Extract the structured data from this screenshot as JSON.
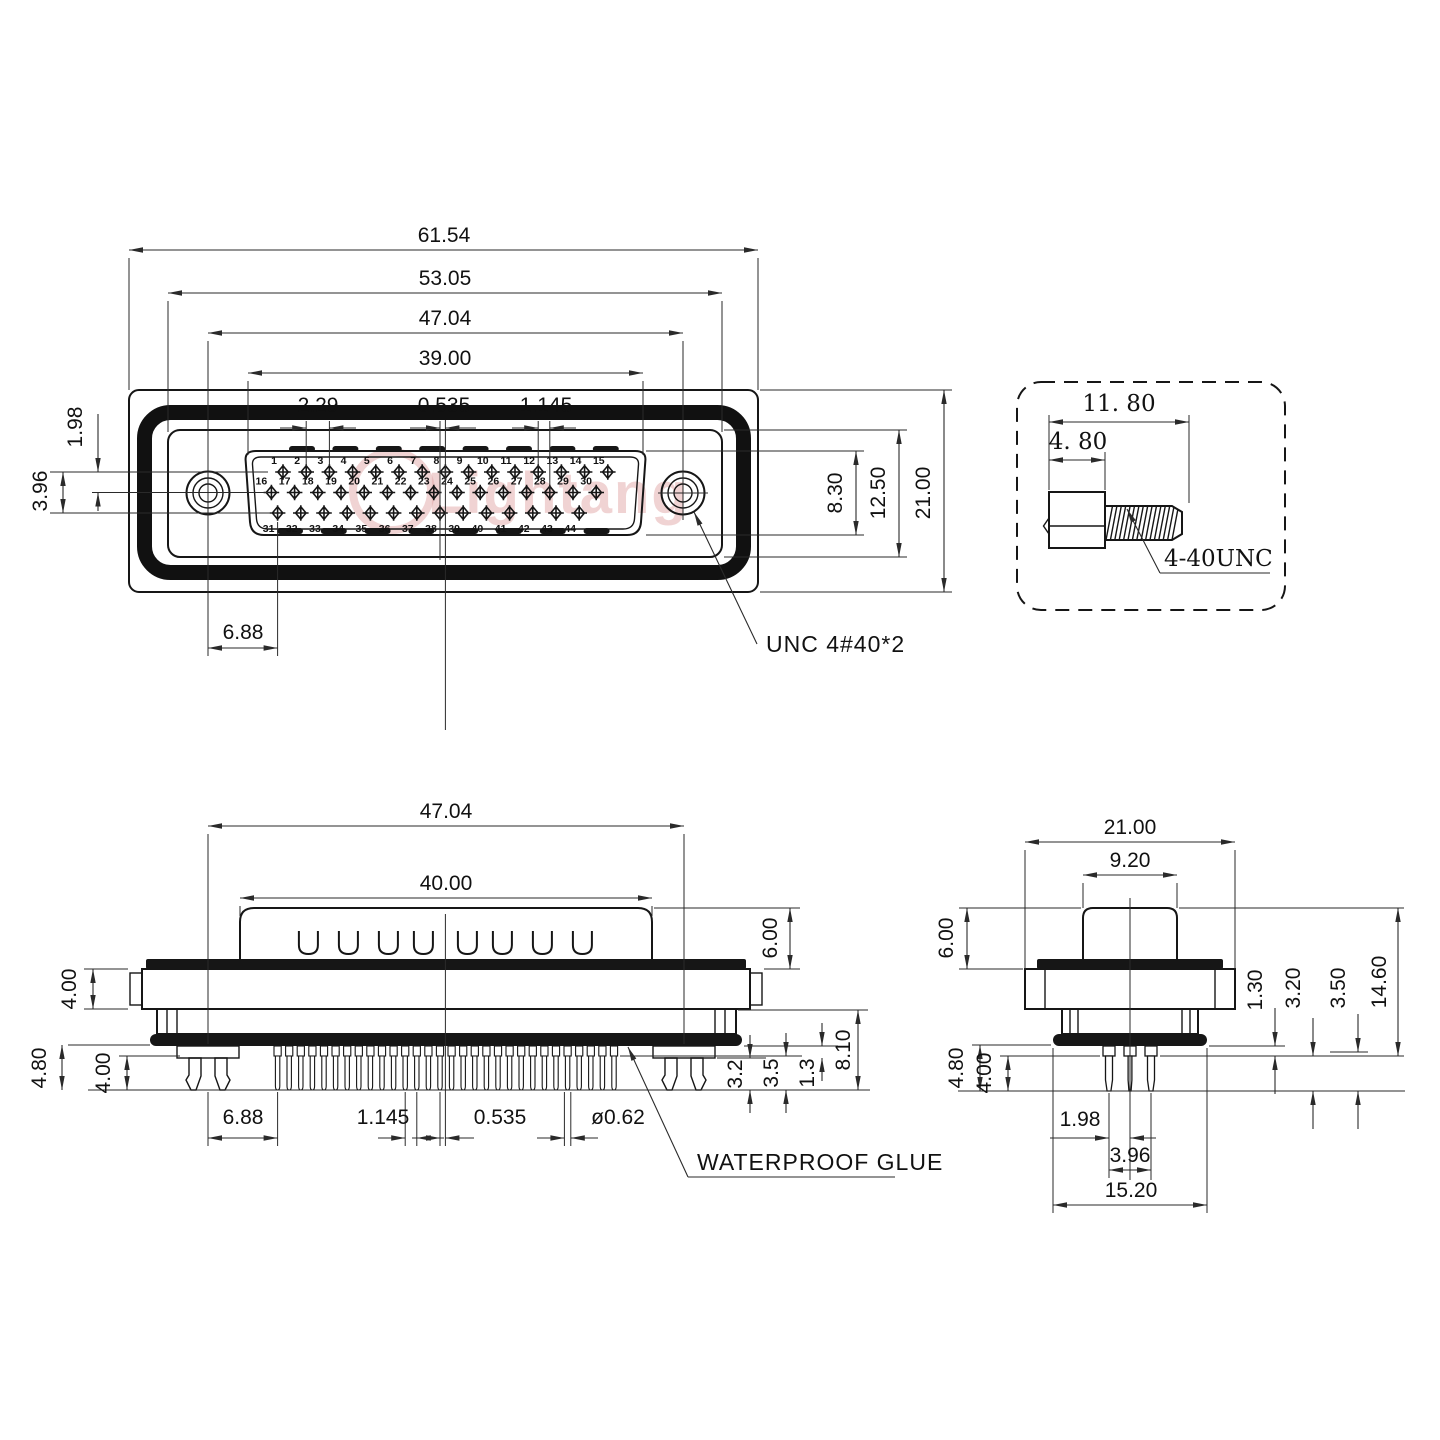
{
  "watermark": {
    "text": "Lightang"
  },
  "front_view": {
    "dims": {
      "w_overall": "61.54",
      "w_inner": "53.05",
      "w_holes": "47.04",
      "w_shield": "39.00",
      "pitch_a": "2.29",
      "pitch_b": "0.535",
      "pitch_c": "1.145",
      "row_gap": "1.98",
      "row_span": "3.96",
      "hole_to_pin": "6.88",
      "h_shield": "8.30",
      "h_inner": "12.50",
      "h_flange": "21.00"
    },
    "unc_label": "UNC 4#40*2",
    "pin_rows": [
      [
        "1",
        "2",
        "3",
        "4",
        "5",
        "6",
        "7",
        "8",
        "9",
        "10",
        "11",
        "12",
        "13",
        "14",
        "15"
      ],
      [
        "16",
        "17",
        "18",
        "19",
        "20",
        "21",
        "22",
        "23",
        "24",
        "25",
        "26",
        "27",
        "28",
        "29",
        "30"
      ],
      [
        "31",
        "32",
        "33",
        "34",
        "35",
        "36",
        "37",
        "38",
        "39",
        "40",
        "41",
        "42",
        "43",
        "44"
      ]
    ]
  },
  "screw_detail": {
    "len_overall": "11. 80",
    "len_head": "4. 80",
    "thread_label": "4-40UNC"
  },
  "side_view": {
    "dims": {
      "w_holes": "47.04",
      "w_body": "40.00",
      "h_body": "6.00",
      "t_flange": "4.00",
      "leg_a": "4.80",
      "leg_b": "4.00",
      "o_hole_pin": "6.88",
      "o_pitch": "1.145",
      "o_half": "0.535",
      "o_dia": "ø0.62",
      "r_a": "3.2",
      "r_b": "3.5",
      "r_c": "1.3",
      "r_d": "8.10"
    },
    "glue_label": "WATERPROOF GLUE"
  },
  "end_view": {
    "dims": {
      "w_flange": "21.00",
      "w_boss": "9.20",
      "h_body": "6.00",
      "leg_a": "4.80",
      "leg_b": "4.00",
      "r_a": "1.30",
      "r_b": "3.20",
      "r_c": "3.50",
      "r_d": "14.60",
      "b_row": "1.98",
      "b_span": "3.96",
      "b_glue": "15.20"
    }
  }
}
